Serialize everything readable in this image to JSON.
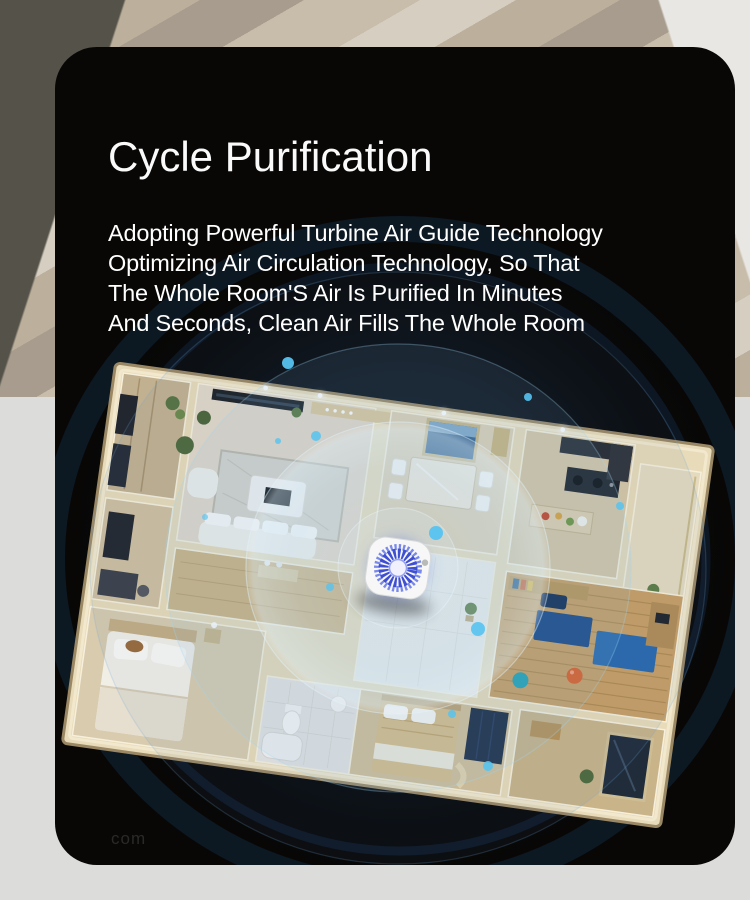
{
  "page": {
    "card_background": "#080706",
    "backdrop": {
      "wall_left_color": "#55524a",
      "wall_right_color": "#e9e7e3",
      "wood_light": "#d5cec1",
      "wood_mid": "#bcb09c",
      "wood_dark": "#a79c8d",
      "floor_color": "#dcdcdb"
    }
  },
  "hero": {
    "title": "Cycle Purification",
    "text_color": "#ffffff",
    "description_lines": [
      "Adopting Powerful Turbine Air Guide Technology",
      "Optimizing Air Circulation Technology, So That",
      "The Whole Room'S Air Is Purified In Minutes",
      "And Seconds, Clean Air Fills The Whole Room"
    ]
  },
  "scene": {
    "device": "air-purifier",
    "ripple_color": "#7fd0f0",
    "particle_color": "#56c3f0",
    "fan_color": "#4150d4",
    "wall_color": "#e8dbb9",
    "watermark": "com"
  }
}
